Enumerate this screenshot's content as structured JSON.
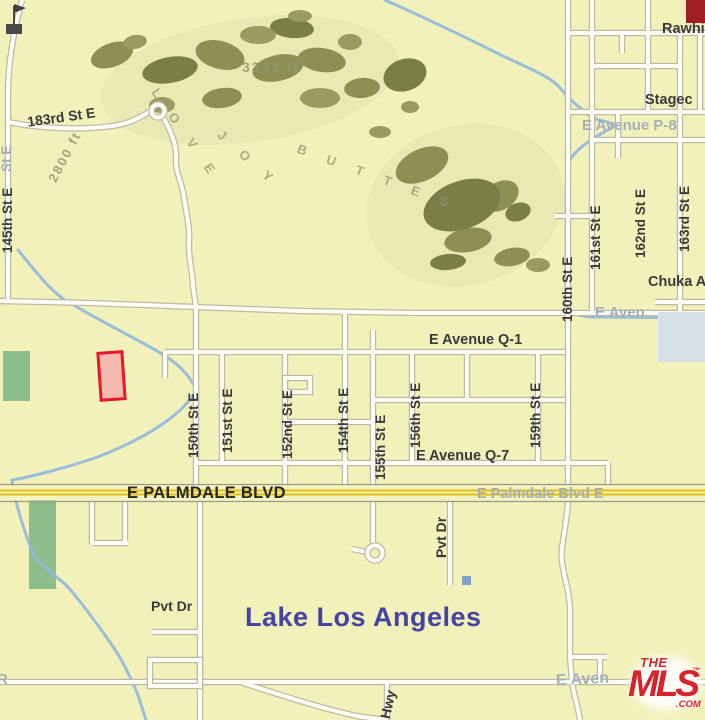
{
  "map": {
    "title": "Lake Los Angeles area parcel map",
    "colors": {
      "background": "#F3F1BA",
      "road_fill": "#FDFDF6",
      "road_casing": "#BDBBA4",
      "creek_blue": "#8FB8DD",
      "highway_yellow": "#E2C41C",
      "parcel_outline": "#E8182B",
      "parcel_fill": "#F5B9AD",
      "park_green": "#8CBE8C",
      "hill_olive": "#8E8F55",
      "city_text": "#4443A6",
      "label_text": "#3A3A3C",
      "ghost_text": "#A5AFB8",
      "building_blue_gray": "#D6E0E9",
      "mls_red": "#D7232B"
    }
  },
  "labels": {
    "street_183rd": "183rd St E",
    "street_145th": "145th St E",
    "ghost_st_e": "St E",
    "elev_3332": "3332 ft",
    "elev_2800": "2800 ft",
    "buttes_part1": "L O V E",
    "buttes_part2": "J O Y",
    "buttes_part3": "B U T T E S",
    "rawhide": "Rawhi",
    "stagecoach": "Stagec",
    "avenue_p8_ghost": "E Avenue P-8",
    "chuka": "Chuka A",
    "avenue_ghost_mid": "E Aven",
    "street_160th": "160th St E",
    "street_161st": "161st St E",
    "street_162nd": "162nd St E",
    "street_163rd": "163rd St E",
    "avenue_q1": "E Avenue Q-1",
    "avenue_q7": "E Avenue Q-7",
    "street_150th": "150th St E",
    "street_151st": "151st St E",
    "street_152nd": "152nd St E",
    "street_154th": "154th St E",
    "street_155th": "155th St E",
    "street_156th": "156th St E",
    "street_159th": "159th St E",
    "palmdale_blvd": "E PALMDALE BLVD",
    "palmdale_ghost": "E Palmdale Blvd E",
    "pvt_dr_horizontal": "Pvt Dr",
    "pvt_dr_vertical": "Pvt Dr",
    "city_name": "Lake Los Angeles",
    "hwy": "Hwy",
    "avenue_ghost_bottom": "E Aven",
    "ghost_r": "R"
  },
  "logo": {
    "the": "THE",
    "mls": "MLS",
    "tm": "™",
    "com": ".COM"
  }
}
